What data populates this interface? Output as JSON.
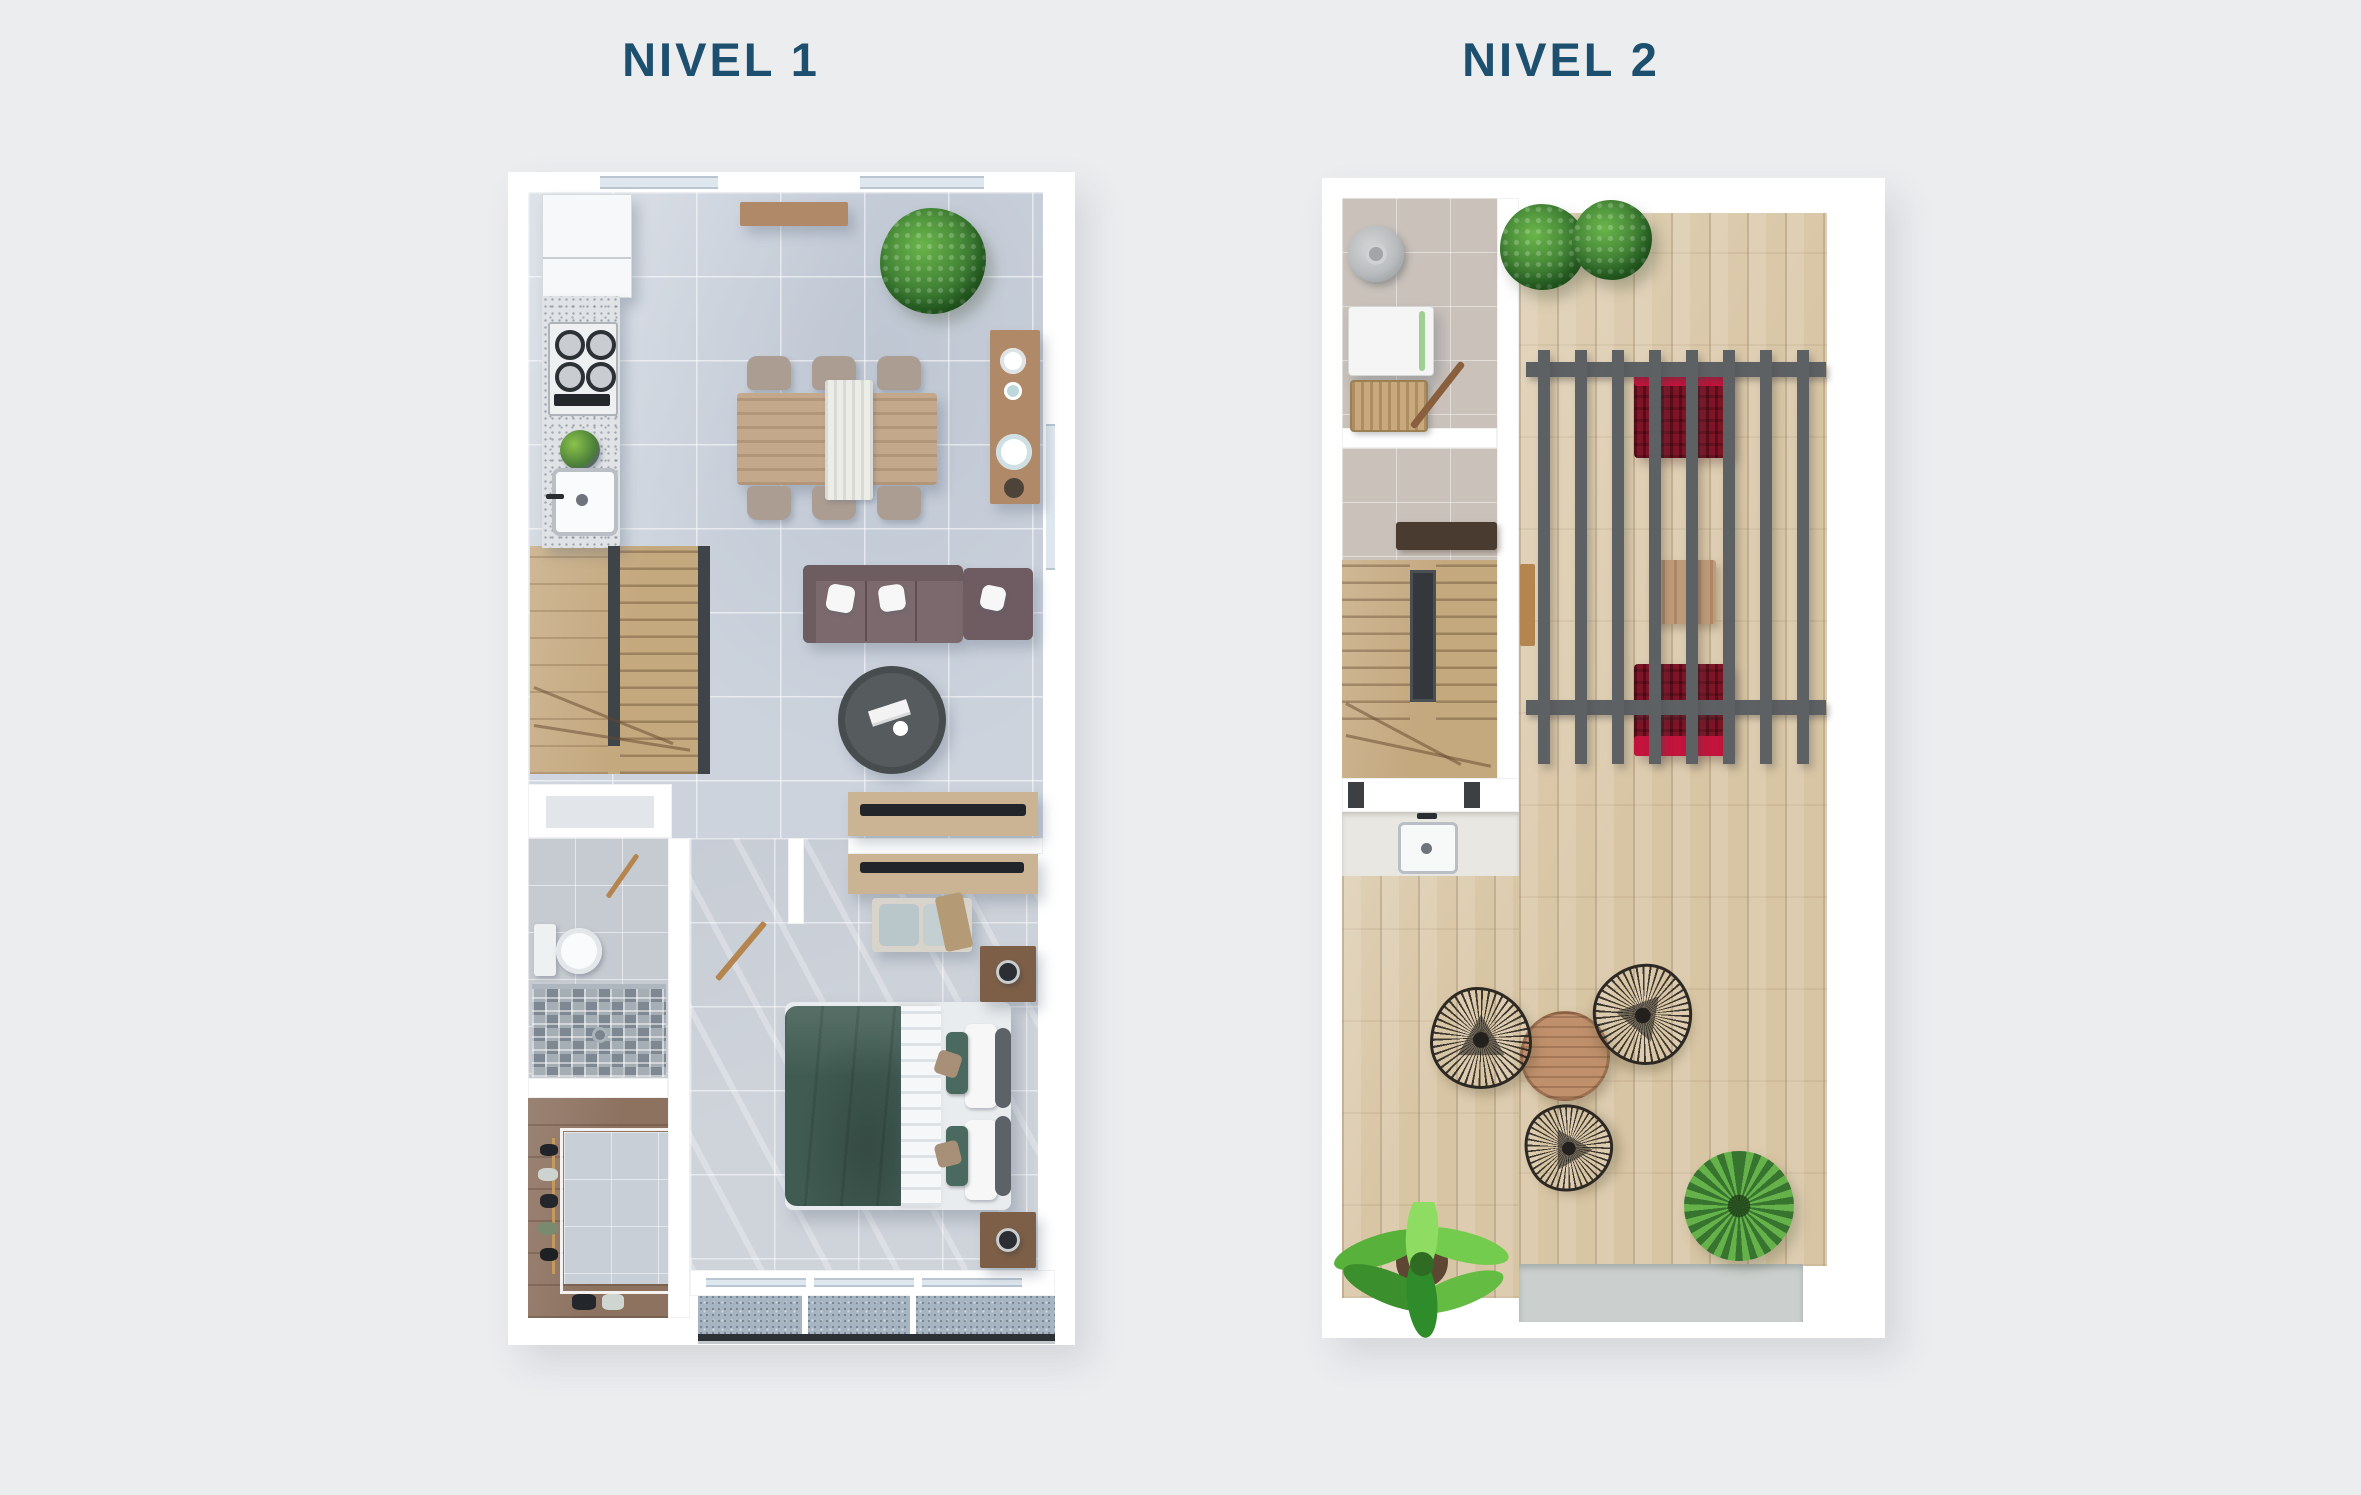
{
  "plans": [
    {
      "name": "nivel-1",
      "title": "NIVEL 1"
    },
    {
      "name": "nivel-2",
      "title": "NIVEL 2"
    }
  ],
  "colors": {
    "bg": "#ecedef",
    "title": "#1d4f6e",
    "wall": "#ffffff",
    "tile": "#ccd3dd",
    "tileBedroom": "#cfd4db",
    "granite": "#e0e3e6",
    "woodStair": "#c4a87e",
    "woodClosetDark": "#8d7260",
    "woodDeck": "#d8c5a4",
    "woodFurn": "#b08968",
    "tableWood": "#c3a88c",
    "chairFabric": "#ac9d92",
    "sofa": "#7b696d",
    "sofaDark": "#6e5c62",
    "coffeeTable": "#565b5e",
    "tvBlack": "#22262a",
    "consoleWood": "#cbb493",
    "duvetGreen": "#405b52",
    "sheetWhite": "#f5f7f8",
    "nightWood": "#7d5f48",
    "balcony": "#a7b4c1",
    "mosaic": "#99a2ab",
    "laundryFloor": "#c9c1ba",
    "heaterGray": "#b9bcbe",
    "basketTan": "#c8a87c",
    "counterTop": "#e9e7e1",
    "pergola": "#5e6164",
    "redDark": "#7e1426",
    "redBright": "#c2143c",
    "deckTable": "#c0906c",
    "plantDark": "#36742f",
    "plantLight": "#6ab54a",
    "shrubGreen": "#66b24a",
    "stepPad": "#cbd0ce",
    "glass": "#dfe7ee",
    "doorWood": "#b5854f",
    "railDark": "#3f4449"
  }
}
